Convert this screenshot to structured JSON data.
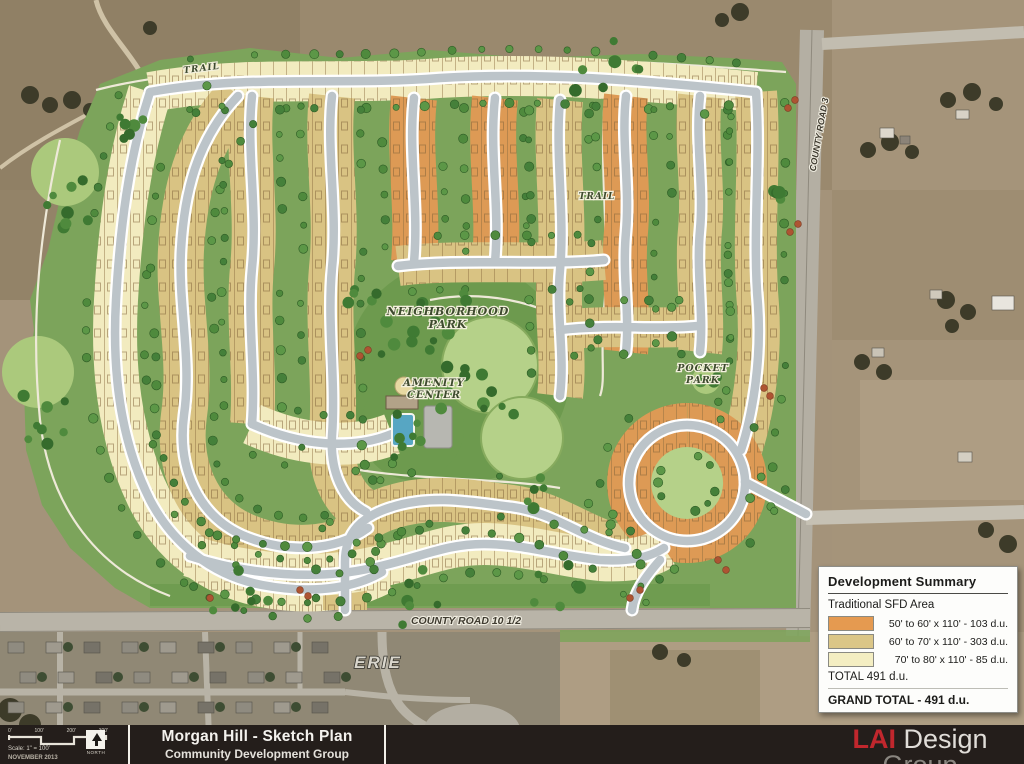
{
  "map": {
    "labels": {
      "trail_top": "TRAIL",
      "trail_mid": "TRAIL",
      "neighborhood_park_line1": "NEIGHBORHOOD",
      "neighborhood_park_line2": "PARK",
      "amenity_center_line1": "AMENITY",
      "amenity_center_line2": "CENTER",
      "pocket_park_line1": "POCKET",
      "pocket_park_line2": "PARK",
      "county_road_10": "COUNTY ROAD 10 1/2",
      "erie": "ERIE",
      "county_road_3": "COUNTY ROAD 3"
    }
  },
  "legend": {
    "title": "Development Summary",
    "subtitle": "Traditional SFD Area",
    "rows": [
      {
        "color": "#e59a50",
        "label": "50' to 60' x 110' - 103 d.u."
      },
      {
        "color": "#dbc687",
        "label": "60' to 70' x 110' - 303 d.u."
      },
      {
        "color": "#f4eec2",
        "label": "70' to 80' x 110' - 85 d.u."
      }
    ],
    "total": "TOTAL 491 d.u.",
    "grand_total": "GRAND TOTAL - 491 d.u."
  },
  "titleblock": {
    "scale_ticks": [
      "0'",
      "100'",
      "200'",
      "300'"
    ],
    "scale_text": "Scale: 1\" = 100'",
    "date": "NOVEMBER 2013",
    "north_label": "NORTH",
    "title": "Morgan Hill - Sketch Plan",
    "subtitle": "Community Development Group"
  },
  "logo": {
    "lai": "LAI",
    "design": "Design",
    "group": "Group",
    "line1": "CORPORATE OFFICE - 8201 Southpark Lane, Suite 110, Littleton, CO 80120    Tel 303.734.1777    Fax 303.734.1778",
    "line2": "Architecture | Planning | Golf Design | Landscape Architecture | Visual Media | www.LAIdesigngroup.com"
  },
  "colors": {
    "lot_orange": "#e59a50",
    "lot_tan": "#dbc687",
    "lot_yellow": "#f4eec2",
    "site_green": "#7ca45b",
    "park_light_green": "#b5d189",
    "street_gray": "#bcc4c9",
    "aerial_tan": "#a4937a",
    "logo_red": "#c1272d",
    "titlebar_dark": "#241e1b"
  }
}
